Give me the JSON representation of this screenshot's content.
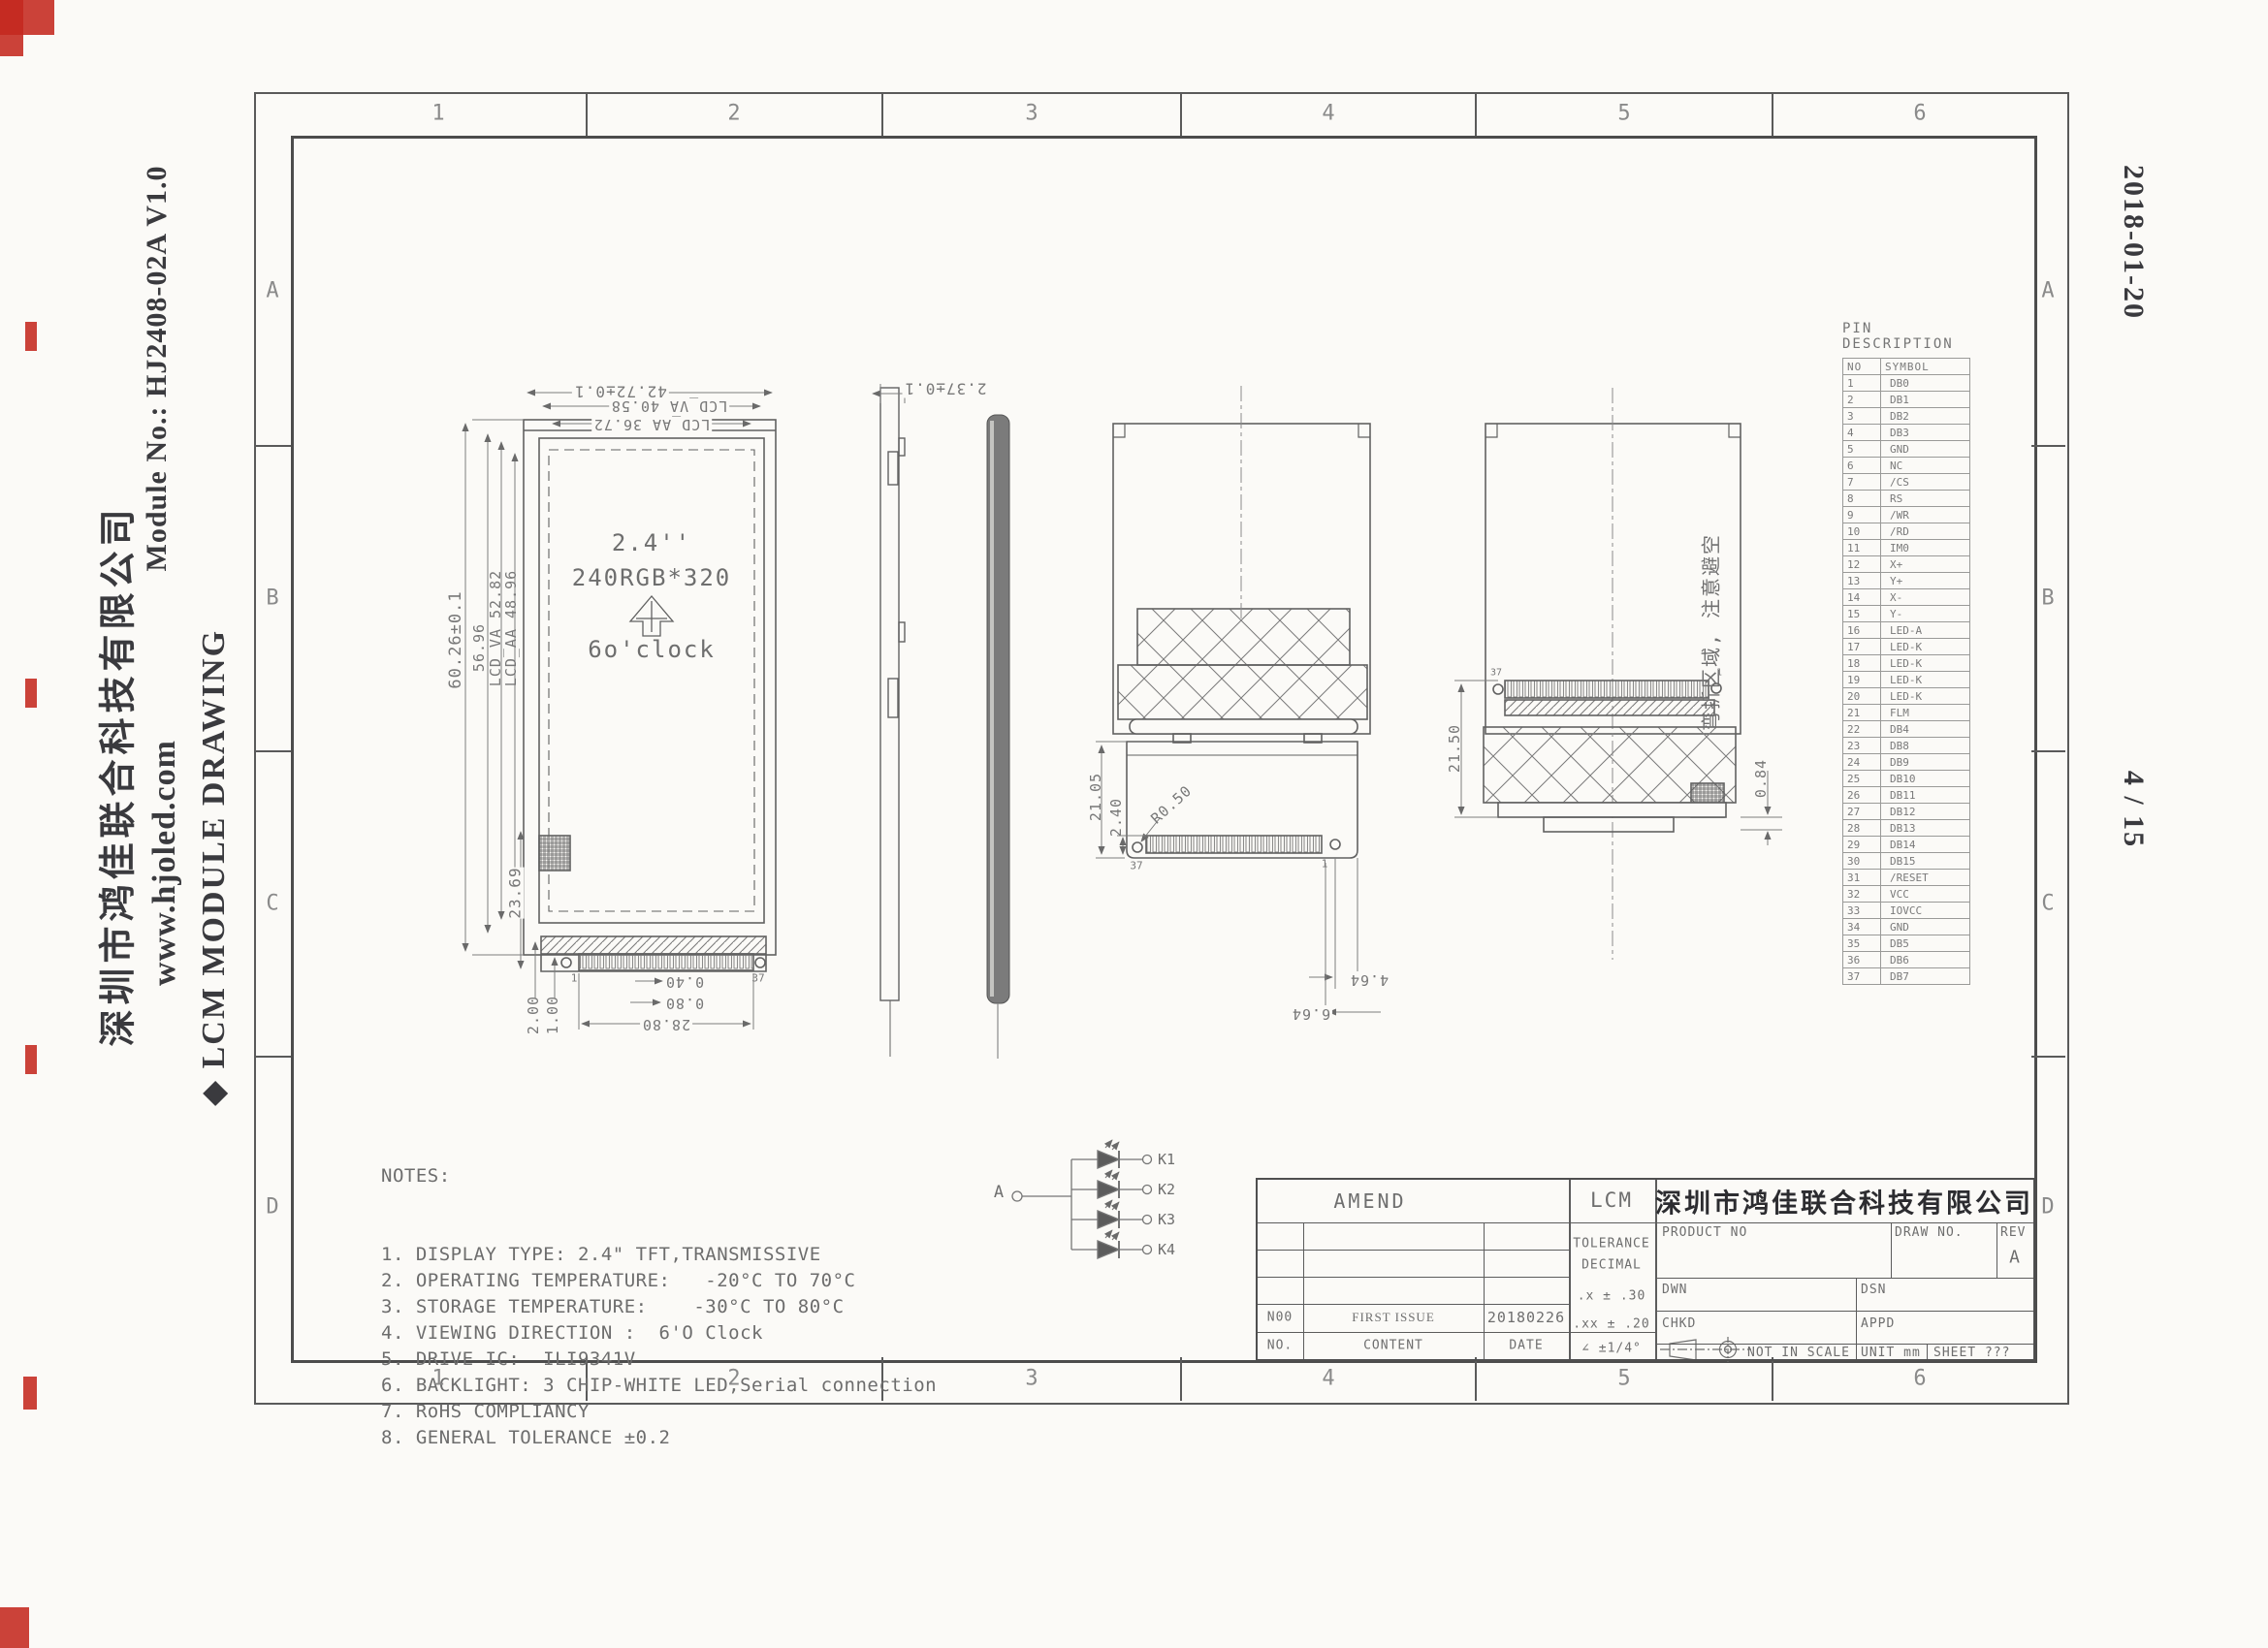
{
  "page": {
    "header": {
      "company_cn": "深圳市鸿佳联合科技有限公司",
      "website": "www.hjoled.com",
      "doc_title": "◆ LCM MODULE DRAWING",
      "module_no": "Module No.: HJ2408-02A   V1.0"
    },
    "stamps": {
      "date": "2018-01-20",
      "page_no": "4 / 15"
    }
  },
  "frame": {
    "columns": [
      "1",
      "2",
      "3",
      "4",
      "5",
      "6"
    ],
    "rows": [
      "A",
      "B",
      "C",
      "D"
    ]
  },
  "front_view": {
    "size_label": "2.4''",
    "resolution": "240RGB*320",
    "viewing": "6o'clock",
    "dim_width_total": "42.72±0.1",
    "dim_width_va": "LCD_VA 40.58",
    "dim_width_aa": "LCD_AA 36.72",
    "dim_height_total": "60.26±0.1",
    "dim_height_mid": "56.96",
    "dim_height_va": "LCD_VA 52.82",
    "dim_height_aa": "LCD_AA 48.96",
    "dim_tail": "23.69",
    "dim_200": "2.00",
    "dim_100": "1.00",
    "dim_040": "0.40",
    "dim_080": "0.80",
    "dim_2880": "28.80",
    "pin_first": "1",
    "pin_last": "37"
  },
  "side_view": {
    "dim_thickness": "2.37±0.1"
  },
  "back_view": {
    "dim_2105": "21.05",
    "dim_240": "2.40",
    "dim_r050": "R0.50",
    "dim_464": "4.64",
    "dim_664": "6.64",
    "pin_left": "37",
    "pin_right": "1"
  },
  "folded_view": {
    "dim_2150": "21.50",
    "dim_084": "0.84",
    "note_cn": "弯折区域, 注意避空",
    "pin_left": "37",
    "pin_right": "1"
  },
  "led_circuit": {
    "anode": "A",
    "cathodes": [
      "K1",
      "K2",
      "K3",
      "K4"
    ]
  },
  "pin_table": {
    "title": "PIN DESCRIPTION",
    "headers": [
      "NO",
      "SYMBOL"
    ],
    "rows": [
      [
        "1",
        "DB0"
      ],
      [
        "2",
        "DB1"
      ],
      [
        "3",
        "DB2"
      ],
      [
        "4",
        "DB3"
      ],
      [
        "5",
        "GND"
      ],
      [
        "6",
        "NC"
      ],
      [
        "7",
        "/CS"
      ],
      [
        "8",
        "RS"
      ],
      [
        "9",
        "/WR"
      ],
      [
        "10",
        "/RD"
      ],
      [
        "11",
        "IM0"
      ],
      [
        "12",
        "X+"
      ],
      [
        "13",
        "Y+"
      ],
      [
        "14",
        "X-"
      ],
      [
        "15",
        "Y-"
      ],
      [
        "16",
        "LED-A"
      ],
      [
        "17",
        "LED-K"
      ],
      [
        "18",
        "LED-K"
      ],
      [
        "19",
        "LED-K"
      ],
      [
        "20",
        "LED-K"
      ],
      [
        "21",
        "FLM"
      ],
      [
        "22",
        "DB4"
      ],
      [
        "23",
        "DB8"
      ],
      [
        "24",
        "DB9"
      ],
      [
        "25",
        "DB10"
      ],
      [
        "26",
        "DB11"
      ],
      [
        "27",
        "DB12"
      ],
      [
        "28",
        "DB13"
      ],
      [
        "29",
        "DB14"
      ],
      [
        "30",
        "DB15"
      ],
      [
        "31",
        "/RESET"
      ],
      [
        "32",
        "VCC"
      ],
      [
        "33",
        "IOVCC"
      ],
      [
        "34",
        "GND"
      ],
      [
        "35",
        "DB5"
      ],
      [
        "36",
        "DB6"
      ],
      [
        "37",
        "DB7"
      ]
    ]
  },
  "notes": {
    "title": "NOTES:",
    "items": [
      "1. DISPLAY TYPE: 2.4\" TFT,TRANSMISSIVE",
      "2. OPERATING TEMPERATURE:   -20°C TO 70°C",
      "3. STORAGE TEMPERATURE:    -30°C TO 80°C",
      "4. VIEWING DIRECTION :  6'O Clock",
      "5. DRIVE IC:  ILI9341V",
      "6. BACKLIGHT: 3 CHIP-WHITE LED,Serial connection",
      "7. RoHS COMPLIANCY",
      "8. GENERAL TOLERANCE ±0.2"
    ]
  },
  "title_block": {
    "amend_label": "AMEND",
    "lcm_label": "LCM",
    "tolerance_title": "TOLERANCE",
    "tolerance_sub": "DECIMAL",
    "tol_x": ".x ± .30",
    "tol_xx": ".xx ± .20",
    "tol_angle": "∠ ±1/4°",
    "company_cn": "深圳市鸿佳联合科技有限公司",
    "product_no_label": "PRODUCT NO",
    "draw_no_label": "DRAW NO.",
    "rev_label": "REV",
    "rev_value": "A",
    "dwn_label": "DWN",
    "dsn_label": "DSN",
    "chkd_label": "CHKD",
    "appd_label": "APPD",
    "scale_note": "NOT IN SCALE",
    "unit_note": "UNIT mm",
    "sheet_note": "SHEET ???",
    "history": {
      "no": "N00",
      "content": "FIRST ISSUE",
      "date": "20180226"
    },
    "history_header": {
      "no": "NO.",
      "content": "CONTENT",
      "date": "DATE"
    }
  },
  "colors": {
    "scan_mark_red": "#c4281f",
    "line_gray": "#5f5f5f"
  }
}
